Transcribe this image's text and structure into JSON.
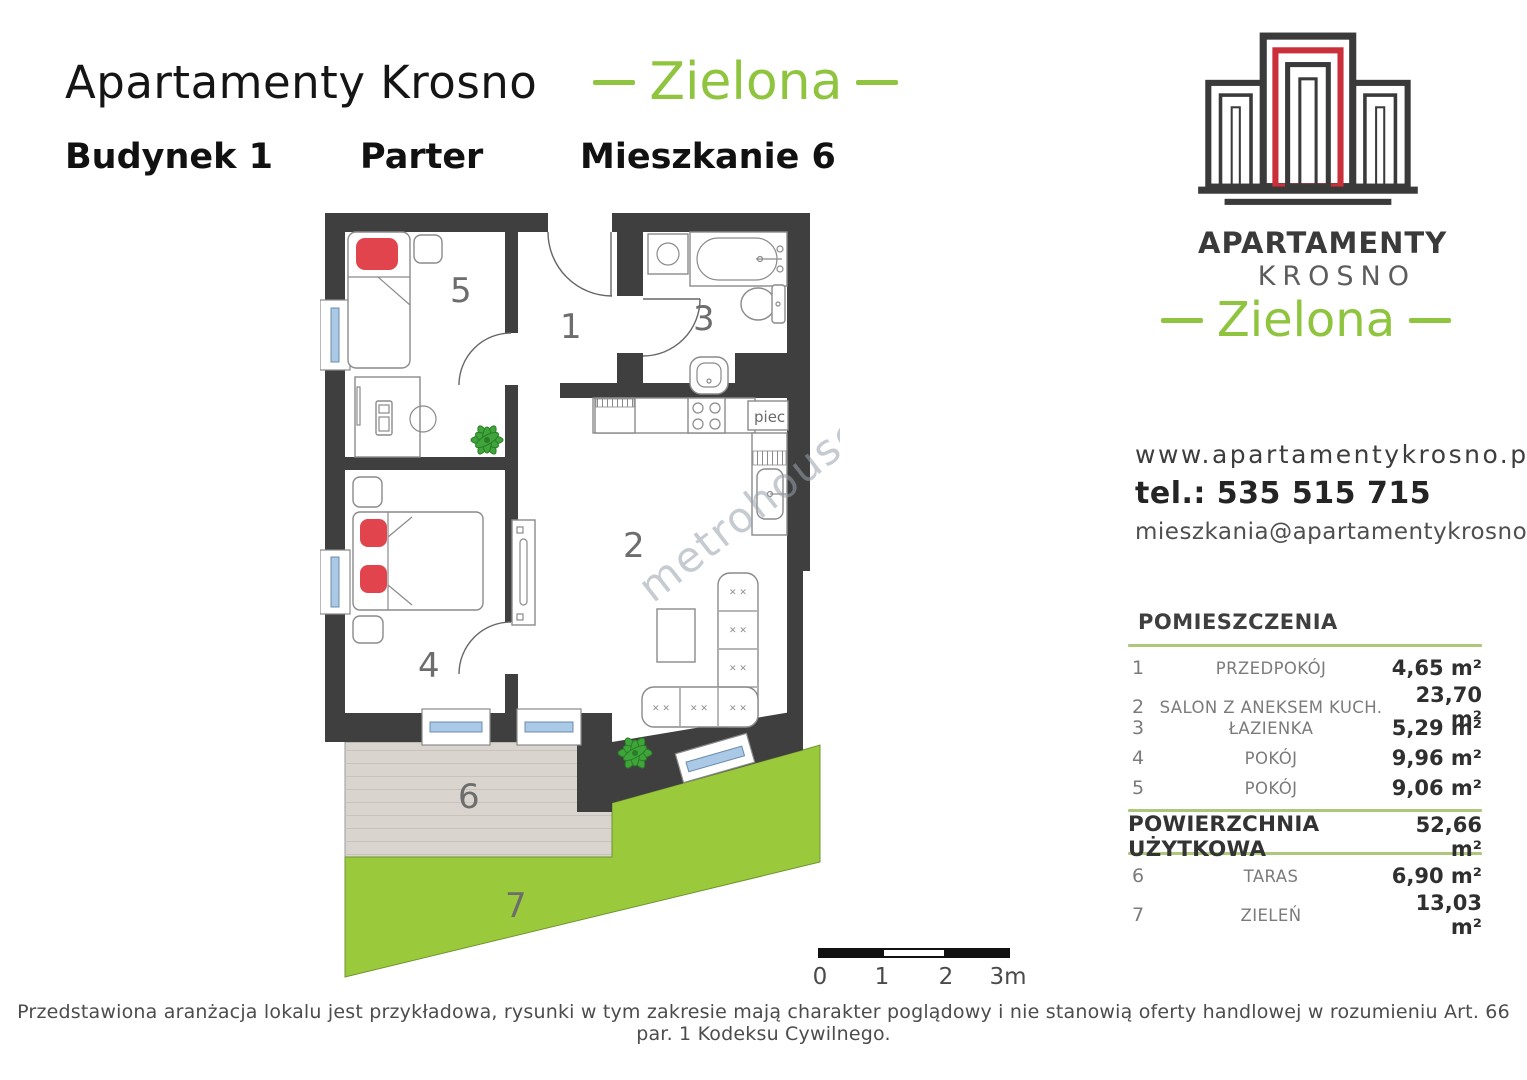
{
  "header": {
    "title": "Apartamenty Krosno",
    "project": "Zielona",
    "building": "Budynek 1",
    "floor": "Parter",
    "unit": "Mieszkanie 6"
  },
  "logo": {
    "brand_line1": "APARTAMENTY",
    "brand_line2": "KROSNO",
    "project": "Zielona"
  },
  "contact": {
    "website": "www.apartamentykrosno.pl",
    "phone": "tel.: 535 515 715",
    "email": "mieszkania@apartamentykrosno.pl"
  },
  "rooms_table": {
    "title": "POMIESZCZENIA",
    "rows": [
      {
        "num": "1",
        "name": "PRZEDPOKÓJ",
        "area": "4,65 m²"
      },
      {
        "num": "2",
        "name": "SALON Z ANEKSEM KUCH.",
        "area": "23,70 m²"
      },
      {
        "num": "3",
        "name": "ŁAZIENKA",
        "area": "5,29 m²"
      },
      {
        "num": "4",
        "name": "POKÓJ",
        "area": "9,96 m²"
      },
      {
        "num": "5",
        "name": "POKÓJ",
        "area": "9,06 m²"
      }
    ],
    "total": {
      "name": "POWIERZCHNIA UŻYTKOWA",
      "area": "52,66 m²"
    },
    "outdoor": [
      {
        "num": "6",
        "name": "TARAS",
        "area": "6,90 m²"
      },
      {
        "num": "7",
        "name": "ZIELEŃ",
        "area": "13,03 m²"
      }
    ]
  },
  "plan": {
    "labels": {
      "hall": "1",
      "salon": "2",
      "bathroom": "3",
      "room4": "4",
      "room5": "5",
      "terrace": "6",
      "green": "7"
    },
    "piec": "piec",
    "watermark": "metrohouse"
  },
  "scale_bar": {
    "ticks": [
      "0",
      "1",
      "2",
      "3m"
    ]
  },
  "disclaimer": "Przedstawiona aranżacja lokalu jest przykładowa, rysunki w tym zakresie mają charakter poglądowy i nie stanowią oferty handlowej w rozumieniu Art. 66 par. 1 Kodeksu Cywilnego.",
  "colors": {
    "accent_green": "#8fc43e",
    "plan_green": "#9aca3c",
    "wall": "#3f3f3f",
    "pillow_red": "#e2444d",
    "terrace_gray": "#d9d5ce",
    "window_blue": "#a9c9e6",
    "table_line_green": "#adc87c",
    "logo_red": "#c9303a"
  }
}
